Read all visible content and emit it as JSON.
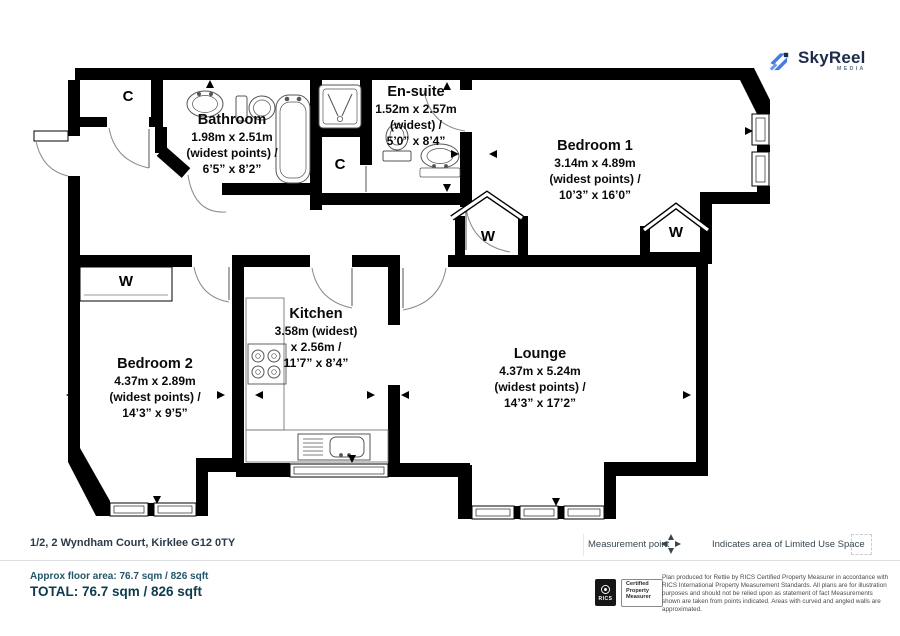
{
  "logo": {
    "name": "SkyReel",
    "sub": "MEDIA"
  },
  "rooms": [
    {
      "id": "bathroom",
      "name": "Bathroom",
      "dims": [
        "1.98m x 2.51m",
        "(widest points) /",
        "6’5” x 8’2”"
      ]
    },
    {
      "id": "ensuite",
      "name": "En-suite",
      "dims": [
        "1.52m x 2.57m",
        "(widest) /",
        "5’0” x 8’4”"
      ]
    },
    {
      "id": "bedroom1",
      "name": "Bedroom 1",
      "dims": [
        "3.14m x 4.89m",
        "(widest points) /",
        "10’3” x 16’0”"
      ]
    },
    {
      "id": "bedroom2",
      "name": "Bedroom 2",
      "dims": [
        "4.37m x 2.89m",
        "(widest points) /",
        "14’3” x 9’5”"
      ]
    },
    {
      "id": "kitchen",
      "name": "Kitchen",
      "dims": [
        "3.58m (widest)",
        "x 2.56m /",
        "11’7” x 8’4”"
      ]
    },
    {
      "id": "lounge",
      "name": "Lounge",
      "dims": [
        "4.37m x 5.24m",
        "(widest points) /",
        "14’3” x 17’2”"
      ]
    }
  ],
  "closets": {
    "c_hall_top": "C",
    "c_mid": "C",
    "w_bedroom2": "W",
    "w_hall": "W",
    "w_bedroom1": "W"
  },
  "address": "1/2, 2 Wyndham Court, Kirklee G12 0TY",
  "legend": {
    "measurement_point": "Measurement point",
    "limited_use": "Indicates area of  Limited Use Space"
  },
  "footer": {
    "approx": "Approx floor area: 76.7 sqm / 826 sqft",
    "total": "TOTAL: 76.7 sqm / 826 sqft",
    "rics_label": "RICS",
    "certified": [
      "Certified",
      "Property",
      "Measurer"
    ],
    "disclaimer": "Plan produced for Rettie by RICS Certified Property Measurer in accordance with RICS International Property Measurement Standards.  All plans are for illustration purposes and should not be relied upon as statement of fact Measurements shown are taken from points indicated. Areas with curved and angled walls are approximated."
  },
  "colors": {
    "wall": "#000000",
    "brand_blue": "#477be4",
    "brand_navy": "#1d2b4c",
    "address_text": "#2c3b49",
    "footer_teal": "#24566a",
    "total_teal": "#0e3b4d"
  }
}
